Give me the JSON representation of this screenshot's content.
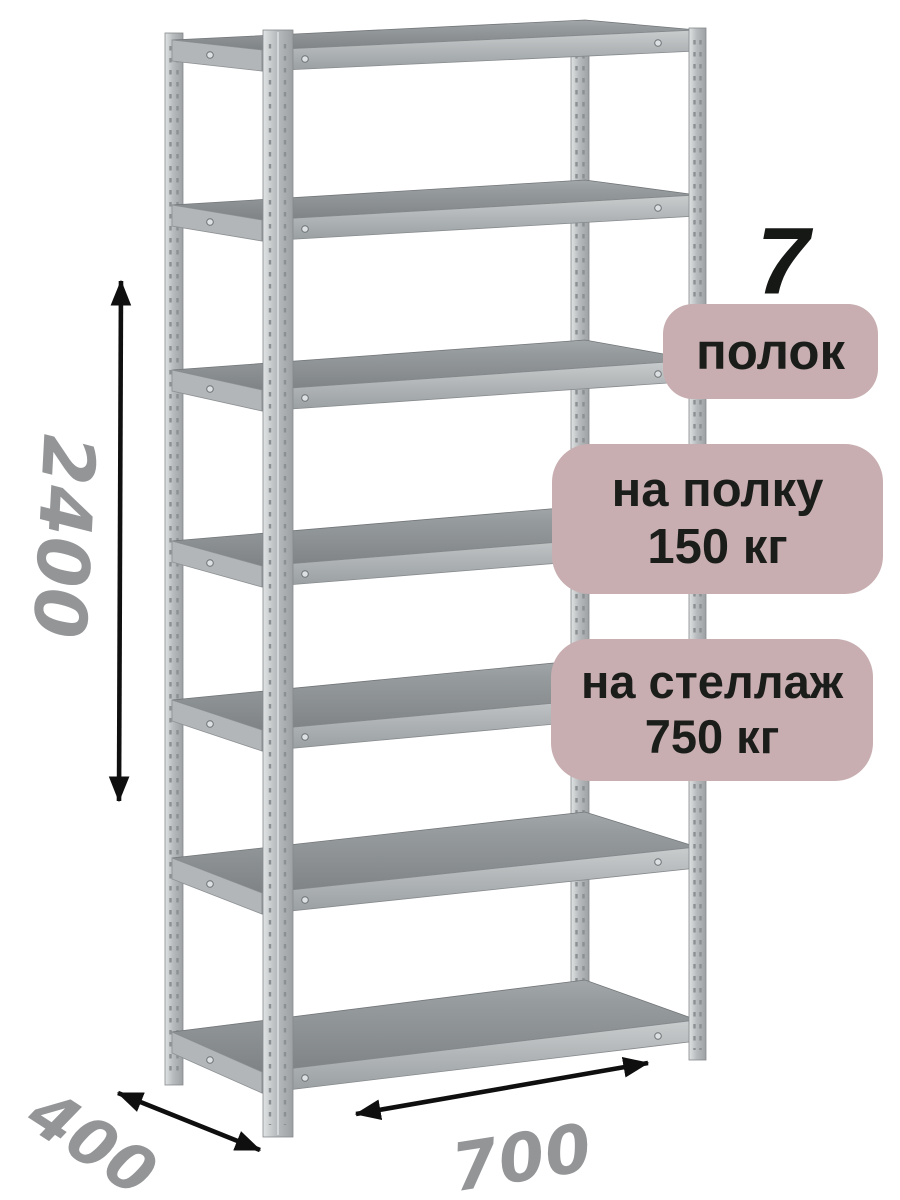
{
  "product": {
    "shelf_count_big": "7",
    "shelf_count_label": "полок",
    "shelf_load": {
      "line1": "на полку",
      "line2": "150 кг"
    },
    "rack_load": {
      "line1": "на стеллаж",
      "line2": "750 кг"
    }
  },
  "dimensions": {
    "height": "2400",
    "depth": "400",
    "width": "700"
  },
  "rack": {
    "shelf_count": 7
  },
  "colors": {
    "background": "#ffffff",
    "badge_bg": "#c8aeb0",
    "badge_text": "#1b1d1b",
    "dimension_text": "#939597",
    "arrow": "#0f0f0f",
    "metal_light": "#d8dbdd",
    "metal_mid": "#aaaeb0",
    "metal_dark": "#84888b"
  }
}
